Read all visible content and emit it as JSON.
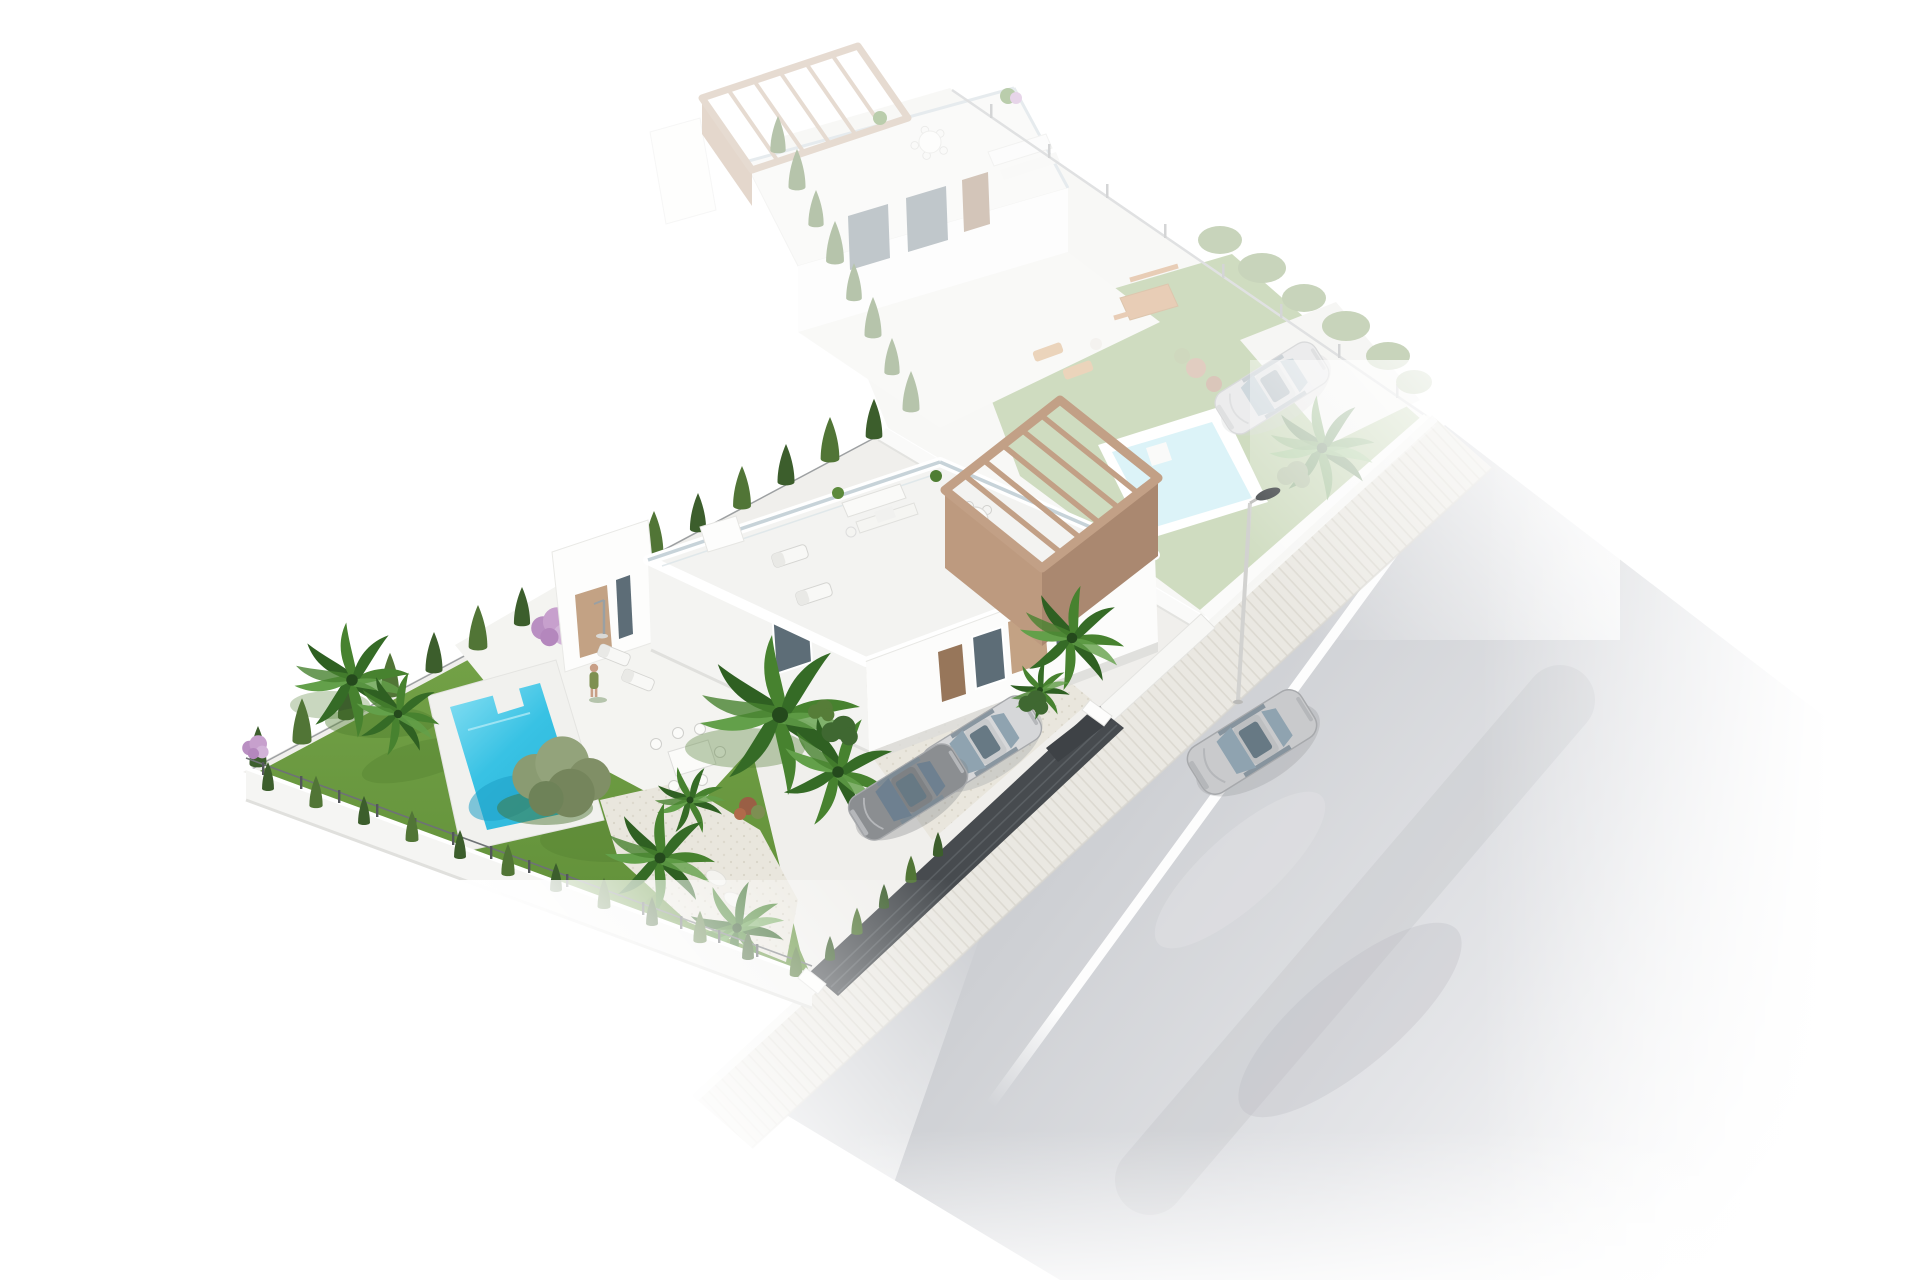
{
  "meta": {
    "title": "Aerial 3D architectural render of detached villas with private pools",
    "media": "architectural-visualization",
    "view": "aerial axonometric",
    "background": "#ffffff",
    "ghost_opacity": "0.42"
  },
  "scene": {
    "description": "Aerial render of a modern white corner-plot villa with garden, cypress hedges, palm trees, private pool and roof terrace with timber pergola; an identical ghosted villa plot behind; a street with paved sidewalk, street lamp, white edge line, one silver car driving and two cars parked at the gravel driveway behind a dark slatted fence.",
    "labels": {
      "render": "3D render of villa development",
      "neighbor_villa": "Neighbouring villa plot (ghosted future phase)",
      "neighbor_pool": "Neighbour private pool",
      "neighbor_lawn": "Neighbour lawn",
      "neighbor_car": "Neighbour parked car",
      "main_plot": "Main villa plot",
      "villa": "Modern white villa",
      "roof_terrace": "Roof terrace with sun loungers and lounge set",
      "pergola": "Timber pergola over roof terrace",
      "pool": "Private swimming pool",
      "lawn": "Garden lawn",
      "hedge_nw": "Cypress hedge along rear boundary",
      "hedge_sw": "Cypress hedge along lower boundary",
      "hedge_front": "Cypress trees along street fence",
      "palm_trees": "Palm trees",
      "olive_tree": "Olive tree",
      "lilac_bush": "Purple flowering shrub",
      "terrace": "Ground-floor terrace with outdoor dining set",
      "person": "Person standing beside the sun loungers",
      "shower": "Outdoor pool shower",
      "driveway": "Gravel driveway",
      "parked_car_silver": "Parked silver car",
      "parked_car_grey": "Parked grey car",
      "entrance_fence": "Dark slatted street fence and gate",
      "boundary_wall": "White boundary wall",
      "sidewalk": "Paved sidewalk",
      "road": "Asphalt street",
      "road_line": "White road edge line",
      "street_lamp": "Street lamp",
      "driving_car": "Silver car driving along the street"
    }
  },
  "colors": {
    "lawn1": "#79a74b",
    "lawn2": "#5d8c36",
    "lawn_shadow": "#4e7c2d",
    "pool_light": "#8fe2f4",
    "pool_mid": "#38c2e4",
    "pool_dark": "#1d9ec6",
    "pool_deck": "#f1f1ee",
    "hedge1": "#3c5e2c",
    "hedge2": "#517536",
    "olive1": "#8a9b72",
    "olive2": "#6e8258",
    "lilac": "#c7a0cd",
    "pergola": "#c2a086",
    "pergola_dark": "#aa8870",
    "pergola_side": "#bd9a7f",
    "wall": "#ffffff",
    "wall_shade": "#efefec",
    "wall_dark": "#e2e2df",
    "concrete": "#f0efec",
    "terrace": "#f4f4f1",
    "glass": "#c5d1d7",
    "window": "#5d6d77",
    "door": "#97765a",
    "tan_panel": "#c3a284",
    "gravel": "#e9e6dd",
    "gravel_dot": "#d8d4c8",
    "road1": "#cdcfd3",
    "road_line": "#ffffff",
    "sidewalk": "#eae8e2",
    "sidewalk_stripe": "#dcd9d1",
    "fence_dark": "#474b4f",
    "fence_slat": "#5a5f63",
    "car_silver": "#cdced0",
    "car_grey": "#8b8e91",
    "car_glass": "#8fa3b0",
    "skin": "#c89f86",
    "dress": "#7e9050"
  }
}
